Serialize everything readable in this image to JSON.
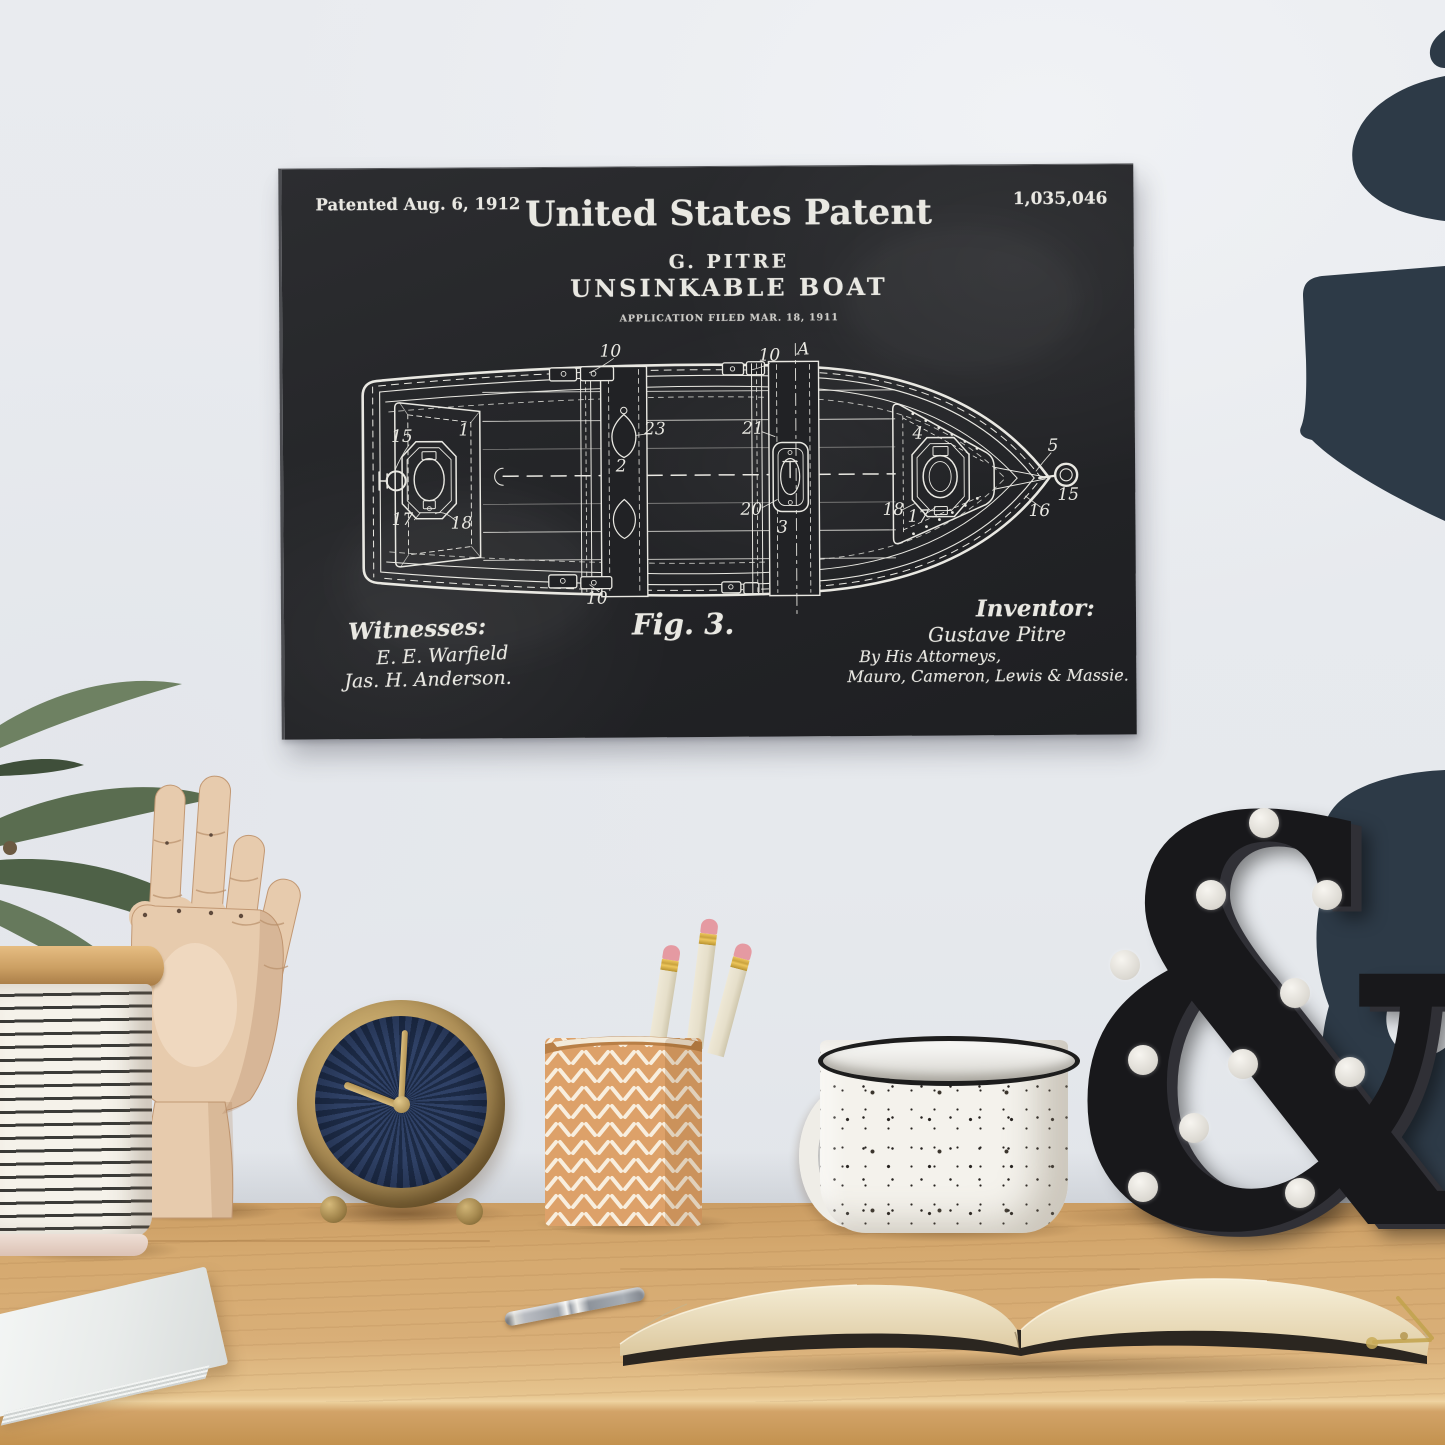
{
  "art_print": {
    "patented_date": "Patented Aug. 6, 1912",
    "patent_number": "1,035,046",
    "header_title": "United States Patent",
    "inventor_caps": "G. PITRE",
    "invention_title": "UNSINKABLE BOAT",
    "application_line": "APPLICATION FILED MAR. 18, 1911",
    "figure_label": "Fig. 3.",
    "witnesses": {
      "heading": "Witnesses:",
      "signatures": [
        "E. E. Warfield",
        "Jas. H. Anderson."
      ]
    },
    "inventor_block": {
      "heading": "Inventor:",
      "signature": "Gustave Pitre",
      "by_line": "By His Attorneys,",
      "attorneys": "Mauro, Cameron, Lewis & Massie."
    },
    "diagram": {
      "labels": [
        "10",
        "A",
        "10",
        "15",
        "1",
        "23",
        "2",
        "17",
        "18",
        "10",
        "21",
        "20",
        "3",
        "4",
        "18",
        "17",
        "5",
        "15",
        "16"
      ]
    },
    "colors": {
      "background": "#242528",
      "chalk": "#e9e8e2"
    }
  },
  "desk_objects": {
    "marquee_letter": "&"
  },
  "colors": {
    "wall": "#e8eaee",
    "wall_decal_navy": "#2d3a47",
    "desk_wood": "#d5a96f",
    "clock_face_navy": "#24334f",
    "clock_frame_brass": "#b2935a",
    "hand_wood": "#e7cbad",
    "canister_stripe": "#3a3a37",
    "pencil_cup_tan": "#dda169",
    "pencil_eraser_pink": "#e59aa2",
    "mug_white": "#f4f2ec",
    "ampersand_black": "#18181b",
    "bulb_white": "#efede8",
    "notebook_pages": "#ead9b8",
    "plant_green": "#66795c",
    "pen_silver": "#9aa0a8"
  }
}
